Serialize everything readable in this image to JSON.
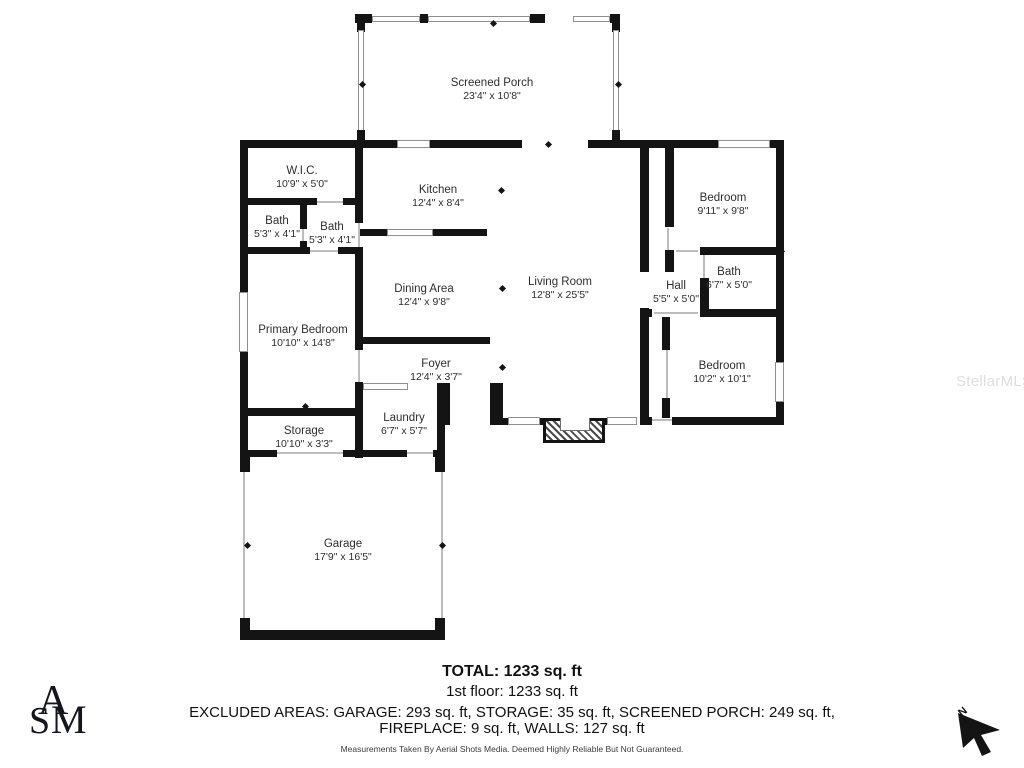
{
  "rooms": [
    {
      "name": "Screened Porch",
      "dims": "23'4\" x 10'8\"",
      "x": 492,
      "y": 77
    },
    {
      "name": "W.I.C.",
      "dims": "10'9\" x 5'0\"",
      "x": 302,
      "y": 165
    },
    {
      "name": "Kitchen",
      "dims": "12'4\" x 8'4\"",
      "x": 438,
      "y": 184
    },
    {
      "name": "Bath",
      "dims": "5'3\" x 4'1\"",
      "x": 277,
      "y": 215
    },
    {
      "name": "Bath",
      "dims": "5'3\" x 4'1\"",
      "x": 332,
      "y": 221
    },
    {
      "name": "Bedroom",
      "dims": "9'11\" x 9'8\"",
      "x": 723,
      "y": 192
    },
    {
      "name": "Dining Area",
      "dims": "12'4\" x 9'8\"",
      "x": 424,
      "y": 283
    },
    {
      "name": "Living Room",
      "dims": "12'8\" x 25'5\"",
      "x": 560,
      "y": 276
    },
    {
      "name": "Bath",
      "dims": "6'7\" x 5'0\"",
      "x": 729,
      "y": 266
    },
    {
      "name": "Hall",
      "dims": "5'5\" x 5'0\"",
      "x": 676,
      "y": 280
    },
    {
      "name": "Primary Bedroom",
      "dims": "10'10\" x 14'8\"",
      "x": 303,
      "y": 324
    },
    {
      "name": "Bedroom",
      "dims": "10'2\" x 10'1\"",
      "x": 722,
      "y": 360
    },
    {
      "name": "Foyer",
      "dims": "12'4\" x 3'7\"",
      "x": 436,
      "y": 358
    },
    {
      "name": "Laundry",
      "dims": "6'7\" x 5'7\"",
      "x": 404,
      "y": 412
    },
    {
      "name": "Storage",
      "dims": "10'10\" x 3'3\"",
      "x": 304,
      "y": 425
    },
    {
      "name": "Garage",
      "dims": "17'9\" x 16'5\"",
      "x": 343,
      "y": 538
    }
  ],
  "footer": {
    "total": "TOTAL: 1233 sq. ft",
    "first_floor": "1st floor: 1233 sq. ft",
    "excluded_line1": "EXCLUDED AREAS: GARAGE: 293 sq. ft, STORAGE: 35 sq. ft, SCREENED PORCH: 249 sq. ft,",
    "excluded_line2": "FIREPLACE: 9 sq. ft, WALLS: 127 sq. ft",
    "disclaimer": "Measurements Taken By Aerial Shots Media. Deemed Highly Reliable But Not Guaranteed."
  },
  "watermark": "StellarMLS",
  "logo": {
    "letter_a": "A",
    "letter_s": "S",
    "letter_m": "M"
  },
  "compass": {
    "label": "N"
  },
  "colors": {
    "wall": "#141414",
    "text": "#2e2e2e",
    "watermark": "#dedede"
  }
}
